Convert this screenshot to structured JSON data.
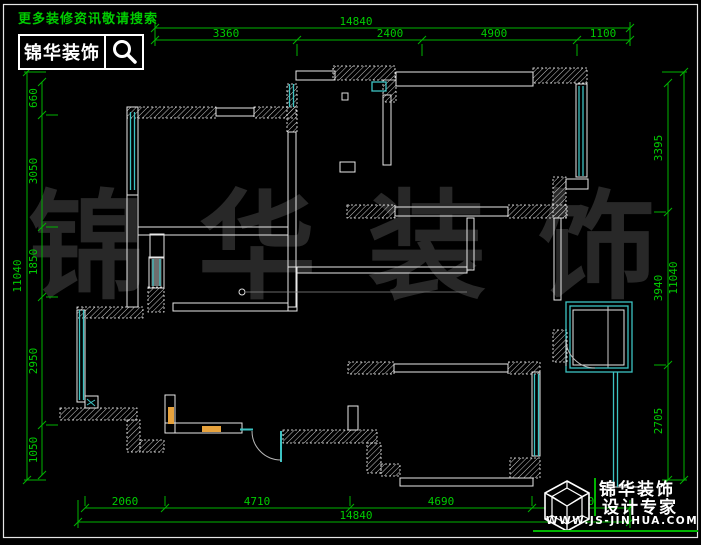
{
  "header": {
    "hint": "更多装修资讯敬请搜索",
    "brand": "锦华装饰"
  },
  "watermark": {
    "text": "锦华装饰"
  },
  "footer": {
    "brand": "锦华装饰",
    "tagline": "设计专家",
    "site": "WWW.JS-JINHUA.COM"
  },
  "dims": {
    "top": {
      "overall": "14840",
      "segments": [
        "3360",
        "2400",
        "4900",
        "1100"
      ]
    },
    "bottom": {
      "overall": "14840",
      "segments": [
        "2060",
        "4710",
        "4690",
        "2230"
      ]
    },
    "left": {
      "overall": "11040",
      "segments": [
        "660",
        "3050",
        "1850",
        "2950",
        "1050"
      ]
    },
    "right": {
      "overall": "11040",
      "segments": [
        "3395",
        "3940",
        "2705"
      ]
    }
  },
  "colors": {
    "dim_line_green": "#00b400",
    "dim_text_green": "#00cc00",
    "window_cyan": "#3cc3c3",
    "counter_orange": "#e8a33d",
    "watermark_gray": "#282828"
  }
}
